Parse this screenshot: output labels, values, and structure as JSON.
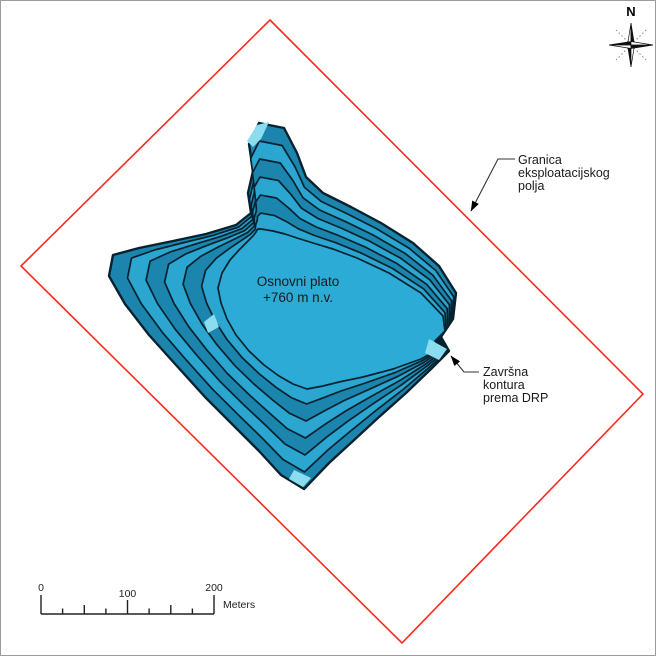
{
  "map": {
    "compass": {
      "label": "N"
    },
    "plateau_label": {
      "line1": "Osnovni plato",
      "line2": "+760 m n.v."
    },
    "boundary_label": {
      "line1": "Granica",
      "line2": "eksploatacijskog",
      "line3": "polja"
    },
    "final_contour_label": {
      "line1": "Završna",
      "line2": "kontura",
      "line3": "prema DRP"
    },
    "scale_bar": {
      "tick0": "0",
      "tick100": "100",
      "tick200": "200",
      "unit": "Meters"
    },
    "colors": {
      "boundary_red": "#fb2a1f",
      "pit_bench": "#2aa6d0",
      "pit_slope": "#1b85ae",
      "pit_plateau": "#2cabd6",
      "pit_outline": "#07222e",
      "pit_highlight": "#8adcee",
      "leader_line": "#333333"
    }
  }
}
